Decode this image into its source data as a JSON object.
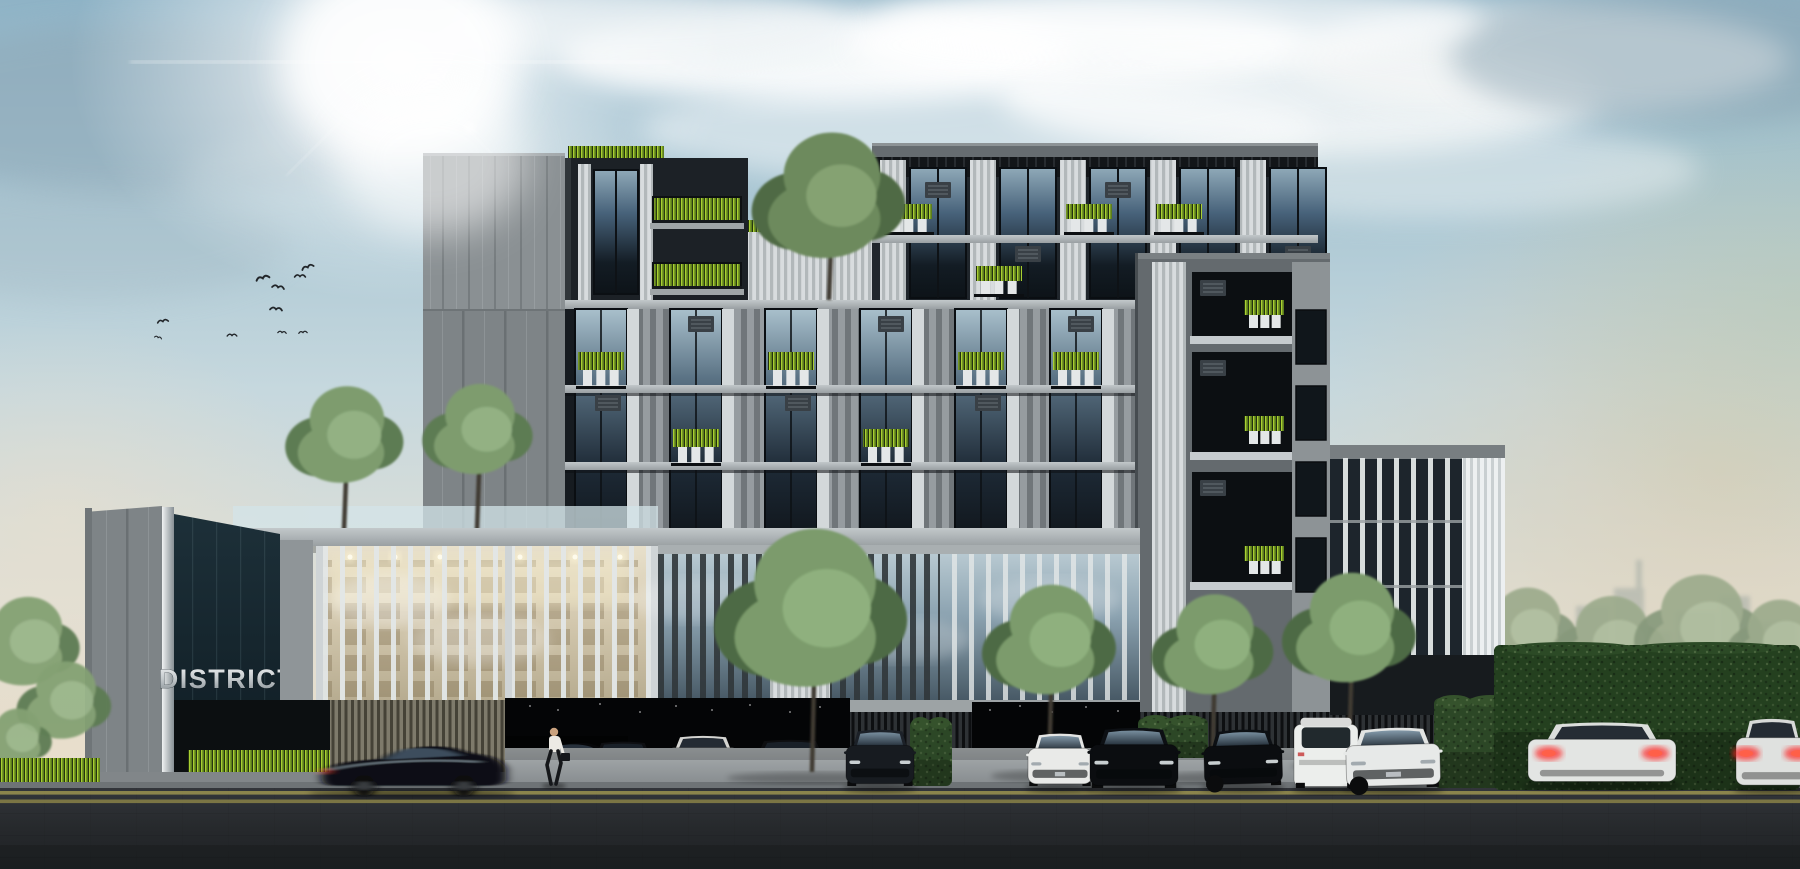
{
  "scene": {
    "type": "architectural-rendering",
    "subject": "Modern condominium building exterior with street, parked cars and landscaping",
    "sign": {
      "line1": "DISTRICT",
      "line2": "48"
    }
  },
  "palette": {
    "sky_top": "#8fb3c6",
    "sky_warm": "#ece4d4",
    "sun": "#ffffff",
    "facade_dark": "#1e2328",
    "panel_gray": "#868c8f",
    "louver_white": "#d7dbdc",
    "glass_dark": "#27333d",
    "lobby_warm": "#d8cfba",
    "plant_lime": "#a6c832",
    "tree_green": "#7b9b6c",
    "hedge_green": "#2c4726",
    "grass_lime": "#9fc832",
    "sign_navy": "#13222a",
    "sign_silver": "#d8dcdd",
    "asphalt": "#292c2f",
    "road_line": "#97904f",
    "taillight_red": "#ff2a2a"
  },
  "sky": {
    "sun": {
      "x": 400,
      "y": 62
    },
    "clouds": [
      {
        "x": 820,
        "y": 55,
        "rx": 260,
        "ry": 48,
        "c": "#ffffff",
        "o": 0.9
      },
      {
        "x": 1080,
        "y": 45,
        "rx": 230,
        "ry": 42,
        "c": "#ffffff",
        "o": 0.85
      },
      {
        "x": 1300,
        "y": 95,
        "rx": 300,
        "ry": 60,
        "c": "#fbfcfc",
        "o": 0.8
      },
      {
        "x": 1540,
        "y": 60,
        "rx": 250,
        "ry": 55,
        "c": "#f4f6f6",
        "o": 0.8
      },
      {
        "x": 640,
        "y": 28,
        "rx": 200,
        "ry": 40,
        "c": "#eef3f5",
        "o": 0.7
      },
      {
        "x": 980,
        "y": 130,
        "rx": 340,
        "ry": 55,
        "c": "#ffffff",
        "o": 0.5
      },
      {
        "x": 1420,
        "y": 170,
        "rx": 280,
        "ry": 48,
        "c": "#f6f8f7",
        "o": 0.45
      },
      {
        "x": 150,
        "y": 110,
        "rx": 280,
        "ry": 85,
        "c": "#8ea7b6",
        "o": 0.55
      },
      {
        "x": 90,
        "y": 240,
        "rx": 200,
        "ry": 60,
        "c": "#a5bac4",
        "o": 0.35
      },
      {
        "x": 1690,
        "y": 55,
        "rx": 240,
        "ry": 70,
        "c": "#8ba4b2",
        "o": 0.5
      },
      {
        "x": 420,
        "y": 180,
        "rx": 240,
        "ry": 60,
        "c": "#b9cdd6",
        "o": 0.35
      },
      {
        "x": 1180,
        "y": 20,
        "rx": 300,
        "ry": 40,
        "c": "#ffffff",
        "o": 0.7
      }
    ],
    "birds": [
      {
        "x": 263,
        "y": 279,
        "s": 1.1,
        "r": -15
      },
      {
        "x": 278,
        "y": 288,
        "s": 1.0,
        "r": 10
      },
      {
        "x": 300,
        "y": 277,
        "s": 0.9,
        "r": 0
      },
      {
        "x": 308,
        "y": 268,
        "s": 1.0,
        "r": -20
      },
      {
        "x": 276,
        "y": 310,
        "s": 1.0,
        "r": 5
      },
      {
        "x": 163,
        "y": 322,
        "s": 0.9,
        "r": -10
      },
      {
        "x": 158,
        "y": 338,
        "s": 0.6,
        "r": 15
      },
      {
        "x": 232,
        "y": 336,
        "s": 0.8,
        "r": 0
      },
      {
        "x": 282,
        "y": 333,
        "s": 0.7,
        "r": 5
      },
      {
        "x": 303,
        "y": 333,
        "s": 0.7,
        "r": -5
      }
    ]
  },
  "background": {
    "skyline": [
      {
        "x": 1548,
        "y": 648,
        "w": 24,
        "h": 55
      },
      {
        "x": 1576,
        "y": 606,
        "w": 34,
        "h": 97
      },
      {
        "x": 1614,
        "y": 588,
        "w": 30,
        "h": 115
      },
      {
        "x": 1648,
        "y": 632,
        "w": 24,
        "h": 71
      },
      {
        "x": 1676,
        "y": 612,
        "w": 40,
        "h": 91
      },
      {
        "x": 1720,
        "y": 596,
        "w": 30,
        "h": 107
      },
      {
        "x": 1756,
        "y": 622,
        "w": 40,
        "h": 81
      },
      {
        "x": 1560,
        "y": 640,
        "w": 16,
        "h": 45,
        "c": "#b49a94"
      },
      {
        "x": 1636,
        "y": 560,
        "w": 6,
        "h": 40
      }
    ],
    "trees_behind_hedge": [
      {
        "cx": 1460,
        "cy": 648,
        "r": 44
      },
      {
        "cx": 1528,
        "cy": 636,
        "r": 52
      },
      {
        "cx": 1612,
        "cy": 650,
        "r": 58
      },
      {
        "cx": 1702,
        "cy": 636,
        "r": 66
      },
      {
        "cx": 1780,
        "cy": 648,
        "r": 52
      }
    ]
  },
  "building": {
    "upper_bays": [
      880,
      970,
      1060,
      1150,
      1240
    ],
    "upper_planters": [
      {
        "x": 886,
        "y": 204
      },
      {
        "x": 1066,
        "y": 204
      },
      {
        "x": 1156,
        "y": 204
      },
      {
        "x": 976,
        "y": 266
      },
      {
        "x": 1246,
        "y": 266
      },
      {
        "x": 1156,
        "y": 266
      }
    ],
    "upper_ac": [
      {
        "x": 925,
        "y": 182
      },
      {
        "x": 1105,
        "y": 182
      },
      {
        "x": 1015,
        "y": 246
      },
      {
        "x": 1285,
        "y": 246
      }
    ],
    "left_balconies": [
      {
        "x": 652,
        "y": 196,
        "w": 90
      },
      {
        "x": 652,
        "y": 262,
        "w": 90
      }
    ],
    "roof_grass": [
      {
        "x": 568,
        "y": 146,
        "w": 96
      },
      {
        "x": 748,
        "y": 220,
        "w": 62
      }
    ],
    "mid_bays": [
      575,
      670,
      765,
      860,
      955,
      1050
    ],
    "mid_planters": [
      {
        "x": 578,
        "y": 352
      },
      {
        "x": 768,
        "y": 352
      },
      {
        "x": 958,
        "y": 352
      },
      {
        "x": 673,
        "y": 429
      },
      {
        "x": 863,
        "y": 429
      },
      {
        "x": 1053,
        "y": 352
      }
    ],
    "mid_ac": [
      {
        "x": 688,
        "y": 316
      },
      {
        "x": 878,
        "y": 316
      },
      {
        "x": 1068,
        "y": 316
      },
      {
        "x": 595,
        "y": 395
      },
      {
        "x": 785,
        "y": 395
      },
      {
        "x": 975,
        "y": 395
      }
    ],
    "niches": [
      {
        "x": 1192,
        "y": 272,
        "w": 100,
        "h": 64
      },
      {
        "x": 1192,
        "y": 352,
        "w": 100,
        "h": 100
      },
      {
        "x": 1192,
        "y": 472,
        "w": 100,
        "h": 110
      }
    ]
  },
  "podium": {
    "lights": [
      350,
      395,
      440,
      520,
      575,
      620
    ],
    "reflections": [
      [
        700,
        600
      ],
      [
        900,
        640
      ],
      [
        1050,
        600
      ]
    ]
  },
  "trees": {
    "podium": [
      {
        "cx": 347,
        "cy": 442,
        "r": 60,
        "ty": 530
      },
      {
        "cx": 480,
        "cy": 436,
        "r": 56,
        "ty": 530
      }
    ],
    "front": [
      {
        "cx": 815,
        "cy": 620,
        "r": 98,
        "ty": 772
      },
      {
        "cx": 1052,
        "cy": 648,
        "r": 68,
        "ty": 770
      },
      {
        "cx": 1215,
        "cy": 652,
        "r": 62,
        "ty": 772
      },
      {
        "cx": 1352,
        "cy": 636,
        "r": 68,
        "ty": 760
      }
    ],
    "left_edge": [
      {
        "cx": 28,
        "cy": 648,
        "r": 55
      },
      {
        "cx": 66,
        "cy": 706,
        "r": 48
      },
      {
        "cx": 18,
        "cy": 742,
        "r": 36
      }
    ]
  },
  "hedges": [
    {
      "x": 910,
      "y": 720,
      "w": 42,
      "h": 66
    },
    {
      "x": 1138,
      "y": 718,
      "w": 70,
      "h": 40
    },
    {
      "x": 1434,
      "y": 698,
      "w": 80,
      "h": 90
    },
    {
      "x": 1494,
      "y": 645,
      "w": 306,
      "h": 145,
      "big": true
    }
  ],
  "street_objects": {
    "person": {
      "x": 546,
      "y": 726
    },
    "garage": {
      "openings": [
        {
          "x": 505,
          "y": 698,
          "w": 345,
          "h": 90
        },
        {
          "x": 972,
          "y": 702,
          "w": 168,
          "h": 86
        }
      ],
      "cars": [
        {
          "style": "side",
          "color": "#0a0c0e",
          "x": 508,
          "y": 738,
          "w": 118,
          "h": 40,
          "dim": true
        },
        {
          "style": "rear",
          "color": "#0c0d0f",
          "x": 588,
          "y": 740,
          "w": 70,
          "h": 42,
          "tail": true
        },
        {
          "style": "rear",
          "color": "#dcdcd8",
          "x": 666,
          "y": 734,
          "w": 74,
          "h": 46,
          "tail": true,
          "light": true
        },
        {
          "style": "rear",
          "color": "#0b0c0e",
          "x": 748,
          "y": 738,
          "w": 84,
          "h": 44,
          "tail": true
        }
      ],
      "lights": [
        [
          530,
          706
        ],
        [
          558,
          710
        ],
        [
          600,
          704
        ],
        [
          640,
          712
        ],
        [
          676,
          706
        ],
        [
          712,
          710
        ],
        [
          750,
          705
        ],
        [
          790,
          712
        ],
        [
          820,
          707
        ],
        [
          990,
          710
        ],
        [
          1020,
          706
        ],
        [
          1052,
          712
        ],
        [
          1086,
          707
        ],
        [
          1118,
          711
        ]
      ]
    },
    "cars": [
      {
        "name": "moving-sedan",
        "style": "side",
        "color": "#0d1014",
        "x": 316,
        "y": 740,
        "w": 192,
        "h": 52,
        "blur": true
      },
      {
        "name": "sedan-front-dark",
        "style": "front",
        "color": "#171b20",
        "x": 846,
        "y": 728,
        "w": 68,
        "h": 58
      },
      {
        "name": "mini-front-white",
        "style": "front",
        "color": "#e9eae8",
        "x": 1028,
        "y": 732,
        "w": 64,
        "h": 54,
        "light": true
      },
      {
        "name": "mercedes-front-black",
        "style": "front",
        "color": "#0b0d10",
        "x": 1090,
        "y": 726,
        "w": 88,
        "h": 62
      },
      {
        "name": "bmw-front-black",
        "style": "front34",
        "color": "#0b0d10",
        "x": 1204,
        "y": 728,
        "w": 78,
        "h": 58
      },
      {
        "name": "suv-rear-white",
        "style": "suv",
        "color": "#eceeec",
        "x": 1294,
        "y": 714,
        "w": 64,
        "h": 74,
        "light": true
      },
      {
        "name": "mercedes-front-white",
        "style": "front34",
        "color": "#e7e9e8",
        "x": 1346,
        "y": 726,
        "w": 94,
        "h": 62,
        "light": true
      },
      {
        "name": "sedan-rear-white",
        "style": "rear",
        "color": "#e3e5e3",
        "x": 1528,
        "y": 720,
        "w": 148,
        "h": 64,
        "light": true,
        "tail": true
      },
      {
        "name": "sedan-rear-white-partial",
        "style": "rear",
        "color": "#dfe1df",
        "x": 1736,
        "y": 716,
        "w": 72,
        "h": 72,
        "light": true,
        "tail": true
      }
    ]
  }
}
